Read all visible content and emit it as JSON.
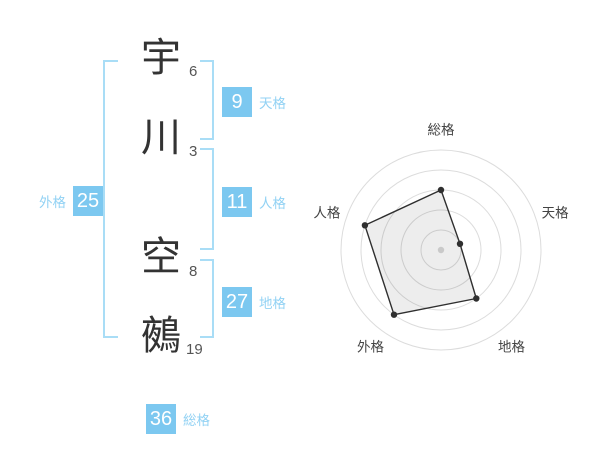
{
  "name_diagram": {
    "characters": [
      {
        "char": "宇",
        "strokes": "6"
      },
      {
        "char": "川",
        "strokes": "3"
      },
      {
        "char": "空",
        "strokes": "8"
      },
      {
        "char": "鵺",
        "strokes": "19"
      }
    ],
    "categories": {
      "tenkaku": {
        "value": "9",
        "label": "天格"
      },
      "jinkaku": {
        "value": "11",
        "label": "人格"
      },
      "chikaku": {
        "value": "27",
        "label": "地格"
      },
      "gaikaku": {
        "value": "25",
        "label": "外格"
      },
      "soukaku": {
        "value": "36",
        "label": "総格"
      }
    },
    "colors": {
      "page_bg": "#ffffff",
      "badge_bg": "#7cc8f0",
      "badge_text": "#ffffff",
      "category_label": "#92d2f4",
      "bracket": "#a9ddf6",
      "kanji": "#333333",
      "stroke_number": "#555555"
    }
  },
  "chart_data": {
    "type": "radar",
    "axes": [
      "総格",
      "天格",
      "地格",
      "外格",
      "人格"
    ],
    "values": [
      60,
      20,
      60,
      80,
      80
    ],
    "max": 100,
    "grid_rings": [
      20,
      40,
      60,
      80,
      100
    ],
    "start_angle_deg": -90,
    "direction": "clockwise",
    "legend": "none",
    "colors": {
      "grid": "#dcdcdc",
      "polygon_stroke": "#2f2f2f",
      "polygon_fill": "rgba(0,0,0,0.07)",
      "vertex_dot": "#2f2f2f",
      "center_dot": "#c9c9c9",
      "axis_label": "#444444"
    }
  }
}
